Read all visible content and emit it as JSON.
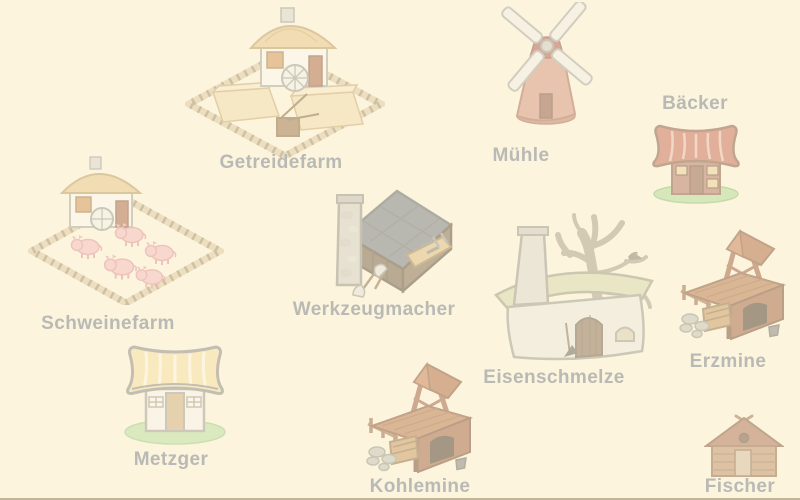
{
  "screen": {
    "background_color": "#FCF4DC",
    "overlay_effect": "washed-out",
    "label_color": "#B9B9B5",
    "bottom_edge_color": "#685E3E"
  },
  "buildings": [
    {
      "id": "getreidefarm",
      "label": "Getreidefarm",
      "icon": "grain-farm-icon",
      "label_position": "below"
    },
    {
      "id": "muehle",
      "label": "Mühle",
      "icon": "windmill-icon",
      "label_position": "below"
    },
    {
      "id": "baecker",
      "label": "Bäcker",
      "icon": "bakery-icon",
      "label_position": "above"
    },
    {
      "id": "schweinefarm",
      "label": "Schweinefarm",
      "icon": "pig-farm-icon",
      "label_position": "below"
    },
    {
      "id": "werkzeugmacher",
      "label": "Werkzeugmacher",
      "icon": "toolmaker-icon",
      "label_position": "below"
    },
    {
      "id": "eisenschmelze",
      "label": "Eisenschmelze",
      "icon": "iron-smelter-icon",
      "label_position": "below"
    },
    {
      "id": "erzmine",
      "label": "Erzmine",
      "icon": "ore-mine-icon",
      "label_position": "below"
    },
    {
      "id": "metzger",
      "label": "Metzger",
      "icon": "butcher-shop-icon",
      "label_position": "below"
    },
    {
      "id": "kohlemine",
      "label": "Kohlemine",
      "icon": "coal-mine-icon",
      "label_position": "below"
    },
    {
      "id": "fischer",
      "label": "Fischer",
      "icon": "fishing-hut-icon",
      "label_position": "below"
    }
  ]
}
